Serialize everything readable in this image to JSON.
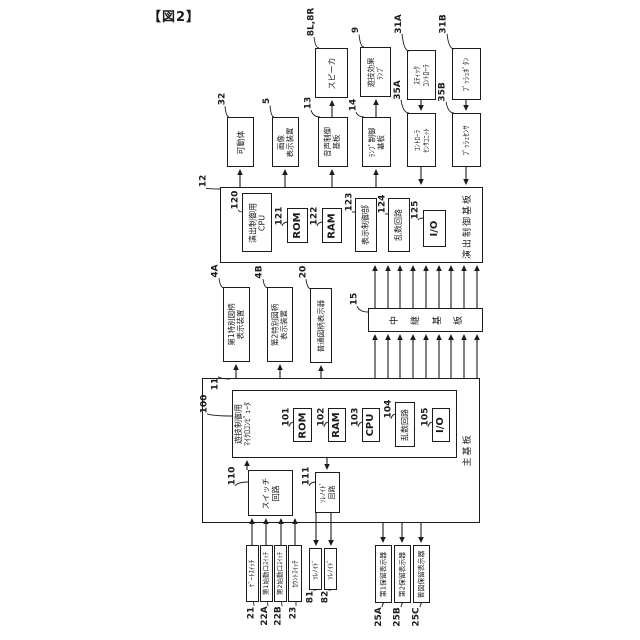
{
  "figure_label": "【図2】",
  "colors": {
    "line": "#1c1c1c",
    "background": "#ffffff"
  },
  "diagram": {
    "nodes": [
      {
        "id": "effect-control-board",
        "type": "board",
        "x": 220,
        "y": 187,
        "w": 263,
        "h": 76,
        "lines": []
      },
      {
        "id": "main-board",
        "type": "board",
        "x": 202,
        "y": 378,
        "w": 278,
        "h": 145,
        "lines": []
      },
      {
        "id": "game-control-microcomputer",
        "type": "block",
        "x": 232,
        "y": 390,
        "w": 225,
        "h": 68,
        "lines": [
          "遊技制御用",
          "ﾏｲｸﾛｺﾝﾋﾟｭｰﾀ"
        ],
        "fs": 8,
        "start": true
      },
      {
        "id": "speaker",
        "type": "block",
        "x": 315,
        "y": 48,
        "w": 33,
        "h": 50,
        "lines": [
          "スピーカ"
        ],
        "fs": 8
      },
      {
        "id": "game-effect-lamp",
        "type": "block",
        "x": 360,
        "y": 47,
        "w": 31,
        "h": 50,
        "lines": [
          "遊技効果",
          "ﾗﾝﾌﾟ"
        ],
        "fs": 7.5
      },
      {
        "id": "stick-controller",
        "type": "block",
        "x": 407,
        "y": 50,
        "w": 29,
        "h": 50,
        "lines": [
          "ｽﾃｨｯｸ",
          "ｺﾝﾄﾛｰﾗ"
        ],
        "fs": 7.5
      },
      {
        "id": "push-button",
        "type": "block",
        "x": 452,
        "y": 48,
        "w": 29,
        "h": 52,
        "lines": [
          "ﾌﾟｯｼｭﾎﾞﾀﾝ"
        ],
        "fs": 7.5
      },
      {
        "id": "movable-body",
        "type": "block",
        "x": 227,
        "y": 117,
        "w": 27,
        "h": 50,
        "lines": [
          "可動体"
        ],
        "fs": 8
      },
      {
        "id": "image-display-device",
        "type": "block",
        "x": 272,
        "y": 117,
        "w": 27,
        "h": 50,
        "lines": [
          "画像",
          "表示装置"
        ],
        "fs": 7.5
      },
      {
        "id": "sound-control-board",
        "type": "block",
        "x": 318,
        "y": 117,
        "w": 30,
        "h": 50,
        "lines": [
          "音声制御",
          "基板"
        ],
        "fs": 7.5
      },
      {
        "id": "lamp-control-board",
        "type": "block",
        "x": 362,
        "y": 117,
        "w": 29,
        "h": 50,
        "lines": [
          "ﾗﾝﾌﾟ制御",
          "基板"
        ],
        "fs": 7.5
      },
      {
        "id": "controller-sensor-unit",
        "type": "block",
        "x": 407,
        "y": 113,
        "w": 29,
        "h": 54,
        "lines": [
          "ｺﾝﾄﾛｰﾗ",
          "ｾﾝｻﾕﾆｯﾄ"
        ],
        "fs": 7
      },
      {
        "id": "push-sensor",
        "type": "block",
        "x": 452,
        "y": 113,
        "w": 29,
        "h": 54,
        "lines": [
          "ﾌﾟｯｼｭｾﾝｻ"
        ],
        "fs": 7.5
      },
      {
        "id": "effect-cpu",
        "type": "block",
        "x": 242,
        "y": 193,
        "w": 30,
        "h": 59,
        "lines": [
          "演出制御用",
          "CPU"
        ],
        "fs": 8
      },
      {
        "id": "effect-rom",
        "type": "block",
        "x": 287,
        "y": 208,
        "w": 21,
        "h": 35,
        "lines": [
          "ROM"
        ],
        "fs": 10,
        "bold": true
      },
      {
        "id": "effect-ram",
        "type": "block",
        "x": 322,
        "y": 208,
        "w": 20,
        "h": 35,
        "lines": [
          "RAM"
        ],
        "fs": 10,
        "bold": true
      },
      {
        "id": "display-control-unit",
        "type": "block",
        "x": 355,
        "y": 198,
        "w": 22,
        "h": 54,
        "lines": [
          "表示制御部"
        ],
        "fs": 8
      },
      {
        "id": "effect-random-circuit",
        "type": "block",
        "x": 388,
        "y": 198,
        "w": 22,
        "h": 54,
        "lines": [
          "乱数回路"
        ],
        "fs": 8
      },
      {
        "id": "effect-io",
        "type": "block",
        "x": 423,
        "y": 210,
        "w": 23,
        "h": 37,
        "lines": [
          "I/O"
        ],
        "fs": 10,
        "bold": true
      },
      {
        "id": "effect-board-label",
        "type": "label",
        "x": 456,
        "y": 192,
        "w": 24,
        "h": 68,
        "lines": [
          "演出制御基板"
        ],
        "fs": 9
      },
      {
        "id": "special-symbol-display-1",
        "type": "block",
        "x": 223,
        "y": 287,
        "w": 27,
        "h": 75,
        "lines": [
          "第1特別図柄",
          "表示装置"
        ],
        "fs": 7.5
      },
      {
        "id": "special-symbol-display-2",
        "type": "block",
        "x": 267,
        "y": 287,
        "w": 26,
        "h": 75,
        "lines": [
          "第2特別図柄",
          "表示装置"
        ],
        "fs": 7.5
      },
      {
        "id": "normal-symbol-display",
        "type": "block",
        "x": 310,
        "y": 288,
        "w": 22,
        "h": 75,
        "lines": [
          "普通図柄表示器"
        ],
        "fs": 7.5
      },
      {
        "id": "relay-board",
        "type": "block",
        "x": 368,
        "y": 308,
        "w": 115,
        "h": 24,
        "lines": [
          "中継基板"
        ],
        "fs": 9,
        "charRow": true
      },
      {
        "id": "main-rom",
        "type": "block",
        "x": 293,
        "y": 408,
        "w": 19,
        "h": 34,
        "lines": [
          "ROM"
        ],
        "fs": 10,
        "bold": true
      },
      {
        "id": "main-ram",
        "type": "block",
        "x": 328,
        "y": 408,
        "w": 18,
        "h": 34,
        "lines": [
          "RAM"
        ],
        "fs": 10,
        "bold": true
      },
      {
        "id": "main-cpu",
        "type": "block",
        "x": 362,
        "y": 408,
        "w": 18,
        "h": 34,
        "lines": [
          "CPU"
        ],
        "fs": 10,
        "bold": true
      },
      {
        "id": "main-random-circuit",
        "type": "block",
        "x": 395,
        "y": 402,
        "w": 20,
        "h": 45,
        "lines": [
          "乱数回路"
        ],
        "fs": 8
      },
      {
        "id": "main-io",
        "type": "block",
        "x": 432,
        "y": 408,
        "w": 18,
        "h": 34,
        "lines": [
          "I/O"
        ],
        "fs": 10,
        "bold": true
      },
      {
        "id": "main-board-label",
        "type": "label",
        "x": 458,
        "y": 426,
        "w": 20,
        "h": 48,
        "lines": [
          "主基板"
        ],
        "fs": 9
      },
      {
        "id": "switch-circuit",
        "type": "block",
        "x": 248,
        "y": 470,
        "w": 45,
        "h": 46,
        "lines": [
          "スイッチ",
          "回路"
        ],
        "fs": 8
      },
      {
        "id": "solenoid-circuit",
        "type": "block",
        "x": 315,
        "y": 472,
        "w": 25,
        "h": 41,
        "lines": [
          "ｿﾚﾉｲﾄﾞ",
          "回路"
        ],
        "fs": 7
      },
      {
        "id": "gate-switch",
        "type": "block",
        "x": 246,
        "y": 545,
        "w": 13,
        "h": 57,
        "lines": [
          "ｹﾞｰﾄｽｲｯﾁ"
        ],
        "fs": 6.8
      },
      {
        "id": "start-switch-1",
        "type": "block",
        "x": 260,
        "y": 545,
        "w": 13,
        "h": 57,
        "lines": [
          "第1始動口ｽｲｯﾁ"
        ],
        "fs": 6.5
      },
      {
        "id": "start-switch-2",
        "type": "block",
        "x": 274,
        "y": 545,
        "w": 13,
        "h": 57,
        "lines": [
          "第2始動口ｽｲｯﾁ"
        ],
        "fs": 6.5
      },
      {
        "id": "count-switch",
        "type": "block",
        "x": 288,
        "y": 545,
        "w": 14,
        "h": 57,
        "lines": [
          "ｶｳﾝﾄｽｲｯﾁ"
        ],
        "fs": 6.8
      },
      {
        "id": "solenoid-81",
        "type": "block",
        "x": 309,
        "y": 548,
        "w": 13,
        "h": 42,
        "lines": [
          "ｿﾚﾉｲﾄﾞ"
        ],
        "fs": 6.8
      },
      {
        "id": "solenoid-82",
        "type": "block",
        "x": 324,
        "y": 548,
        "w": 13,
        "h": 42,
        "lines": [
          "ｿﾚﾉｲﾄﾞ"
        ],
        "fs": 6.8
      },
      {
        "id": "hold-display-1",
        "type": "block",
        "x": 375,
        "y": 545,
        "w": 17,
        "h": 58,
        "lines": [
          "第1保留表示器"
        ],
        "fs": 6.8
      },
      {
        "id": "hold-display-2",
        "type": "block",
        "x": 394,
        "y": 545,
        "w": 17,
        "h": 58,
        "lines": [
          "第2保留表示器"
        ],
        "fs": 6.8
      },
      {
        "id": "normal-hold-display",
        "type": "block",
        "x": 413,
        "y": 545,
        "w": 17,
        "h": 58,
        "lines": [
          "普図保留表示器"
        ],
        "fs": 6.8
      }
    ],
    "refs": [
      {
        "t": "8L,8R",
        "cx": 311,
        "cy": 22,
        "tx": 319,
        "ty": 48
      },
      {
        "t": "9",
        "cx": 356,
        "cy": 30,
        "tx": 364,
        "ty": 47
      },
      {
        "t": "31A",
        "cx": 399,
        "cy": 24,
        "tx": 409,
        "ty": 51
      },
      {
        "t": "31B",
        "cx": 444,
        "cy": 24,
        "tx": 454,
        "ty": 49
      },
      {
        "t": "32",
        "cx": 222,
        "cy": 99,
        "tx": 229,
        "ty": 117
      },
      {
        "t": "5",
        "cx": 267,
        "cy": 101,
        "tx": 274,
        "ty": 117
      },
      {
        "t": "13",
        "cx": 308,
        "cy": 103,
        "tx": 320,
        "ty": 117
      },
      {
        "t": "14",
        "cx": 353,
        "cy": 105,
        "tx": 364,
        "ty": 117
      },
      {
        "t": "35A",
        "cx": 398,
        "cy": 90,
        "tx": 409,
        "ty": 113
      },
      {
        "t": "35B",
        "cx": 443,
        "cy": 92,
        "tx": 454,
        "ty": 113
      },
      {
        "t": "12",
        "cx": 203,
        "cy": 181,
        "tx": 220,
        "ty": 189
      },
      {
        "t": "120",
        "cx": 235,
        "cy": 200,
        "tx": 243,
        "ty": 212
      },
      {
        "t": "121",
        "cx": 279,
        "cy": 216,
        "tx": 288,
        "ty": 222
      },
      {
        "t": "122",
        "cx": 314,
        "cy": 216,
        "tx": 323,
        "ty": 222
      },
      {
        "t": "123",
        "cx": 349,
        "cy": 202,
        "tx": 356,
        "ty": 212
      },
      {
        "t": "124",
        "cx": 382,
        "cy": 204,
        "tx": 389,
        "ty": 214
      },
      {
        "t": "125",
        "cx": 415,
        "cy": 210,
        "tx": 424,
        "ty": 218
      },
      {
        "t": "4A",
        "cx": 216,
        "cy": 271,
        "tx": 224,
        "ty": 288
      },
      {
        "t": "4B",
        "cx": 260,
        "cy": 272,
        "tx": 268,
        "ty": 288
      },
      {
        "t": "20",
        "cx": 303,
        "cy": 272,
        "tx": 311,
        "ty": 289
      },
      {
        "t": "15",
        "cx": 354,
        "cy": 299,
        "tx": 368,
        "ty": 312
      },
      {
        "t": "100",
        "cx": 204,
        "cy": 404,
        "tx": 232,
        "ty": 416
      },
      {
        "t": "11",
        "cx": 215,
        "cy": 384,
        "tx": 230,
        "ty": 379
      },
      {
        "t": "101",
        "cx": 286,
        "cy": 417,
        "tx": 294,
        "ty": 422
      },
      {
        "t": "102",
        "cx": 321,
        "cy": 417,
        "tx": 329,
        "ty": 422
      },
      {
        "t": "103",
        "cx": 355,
        "cy": 417,
        "tx": 363,
        "ty": 422
      },
      {
        "t": "104",
        "cx": 388,
        "cy": 409,
        "tx": 396,
        "ty": 414
      },
      {
        "t": "105",
        "cx": 425,
        "cy": 417,
        "tx": 433,
        "ty": 422
      },
      {
        "t": "110",
        "cx": 232,
        "cy": 476,
        "tx": 248,
        "ty": 482
      },
      {
        "t": "111",
        "cx": 306,
        "cy": 476,
        "tx": 316,
        "ty": 482
      },
      {
        "t": "21",
        "cx": 251,
        "cy": 613,
        "tx": 253,
        "ty": 602
      },
      {
        "t": "22A",
        "cx": 265,
        "cy": 616,
        "tx": 267,
        "ty": 602
      },
      {
        "t": "22B",
        "cx": 279,
        "cy": 616,
        "tx": 281,
        "ty": 602
      },
      {
        "t": "23",
        "cx": 293,
        "cy": 613,
        "tx": 296,
        "ty": 602
      },
      {
        "t": "81",
        "cx": 310,
        "cy": 597,
        "tx": 316,
        "ty": 590
      },
      {
        "t": "82",
        "cx": 325,
        "cy": 597,
        "tx": 331,
        "ty": 590
      },
      {
        "t": "25A",
        "cx": 379,
        "cy": 617,
        "tx": 384,
        "ty": 603
      },
      {
        "t": "25B",
        "cx": 398,
        "cy": 617,
        "tx": 403,
        "ty": 603
      },
      {
        "t": "25C",
        "cx": 417,
        "cy": 617,
        "tx": 422,
        "ty": 603
      }
    ],
    "arrows": [
      [
        240,
        187,
        169
      ],
      [
        285,
        187,
        169
      ],
      [
        332,
        187,
        169
      ],
      [
        376,
        187,
        169
      ],
      [
        332,
        117,
        100
      ],
      [
        376,
        117,
        99
      ],
      [
        421,
        100,
        111
      ],
      [
        466,
        100,
        111
      ],
      [
        421,
        167,
        185
      ],
      [
        466,
        167,
        185
      ],
      [
        236,
        378,
        364
      ],
      [
        280,
        378,
        364
      ],
      [
        321,
        378,
        365
      ],
      [
        375,
        308,
        265
      ],
      [
        388,
        308,
        265
      ],
      [
        400,
        308,
        265
      ],
      [
        413,
        308,
        265
      ],
      [
        426,
        308,
        265
      ],
      [
        439,
        308,
        265
      ],
      [
        451,
        308,
        265
      ],
      [
        464,
        308,
        265
      ],
      [
        477,
        308,
        265
      ],
      [
        375,
        378,
        334
      ],
      [
        388,
        378,
        334
      ],
      [
        400,
        378,
        334
      ],
      [
        413,
        378,
        334
      ],
      [
        426,
        378,
        334
      ],
      [
        439,
        378,
        334
      ],
      [
        451,
        378,
        334
      ],
      [
        464,
        378,
        334
      ],
      [
        477,
        378,
        334
      ],
      [
        247,
        470,
        460
      ],
      [
        327,
        458,
        470
      ],
      [
        252,
        545,
        518
      ],
      [
        266,
        545,
        518
      ],
      [
        281,
        545,
        518
      ],
      [
        295,
        545,
        518
      ],
      [
        316,
        513,
        546
      ],
      [
        331,
        513,
        546
      ],
      [
        383,
        523,
        543
      ],
      [
        402,
        523,
        543
      ],
      [
        421,
        523,
        543
      ]
    ]
  }
}
